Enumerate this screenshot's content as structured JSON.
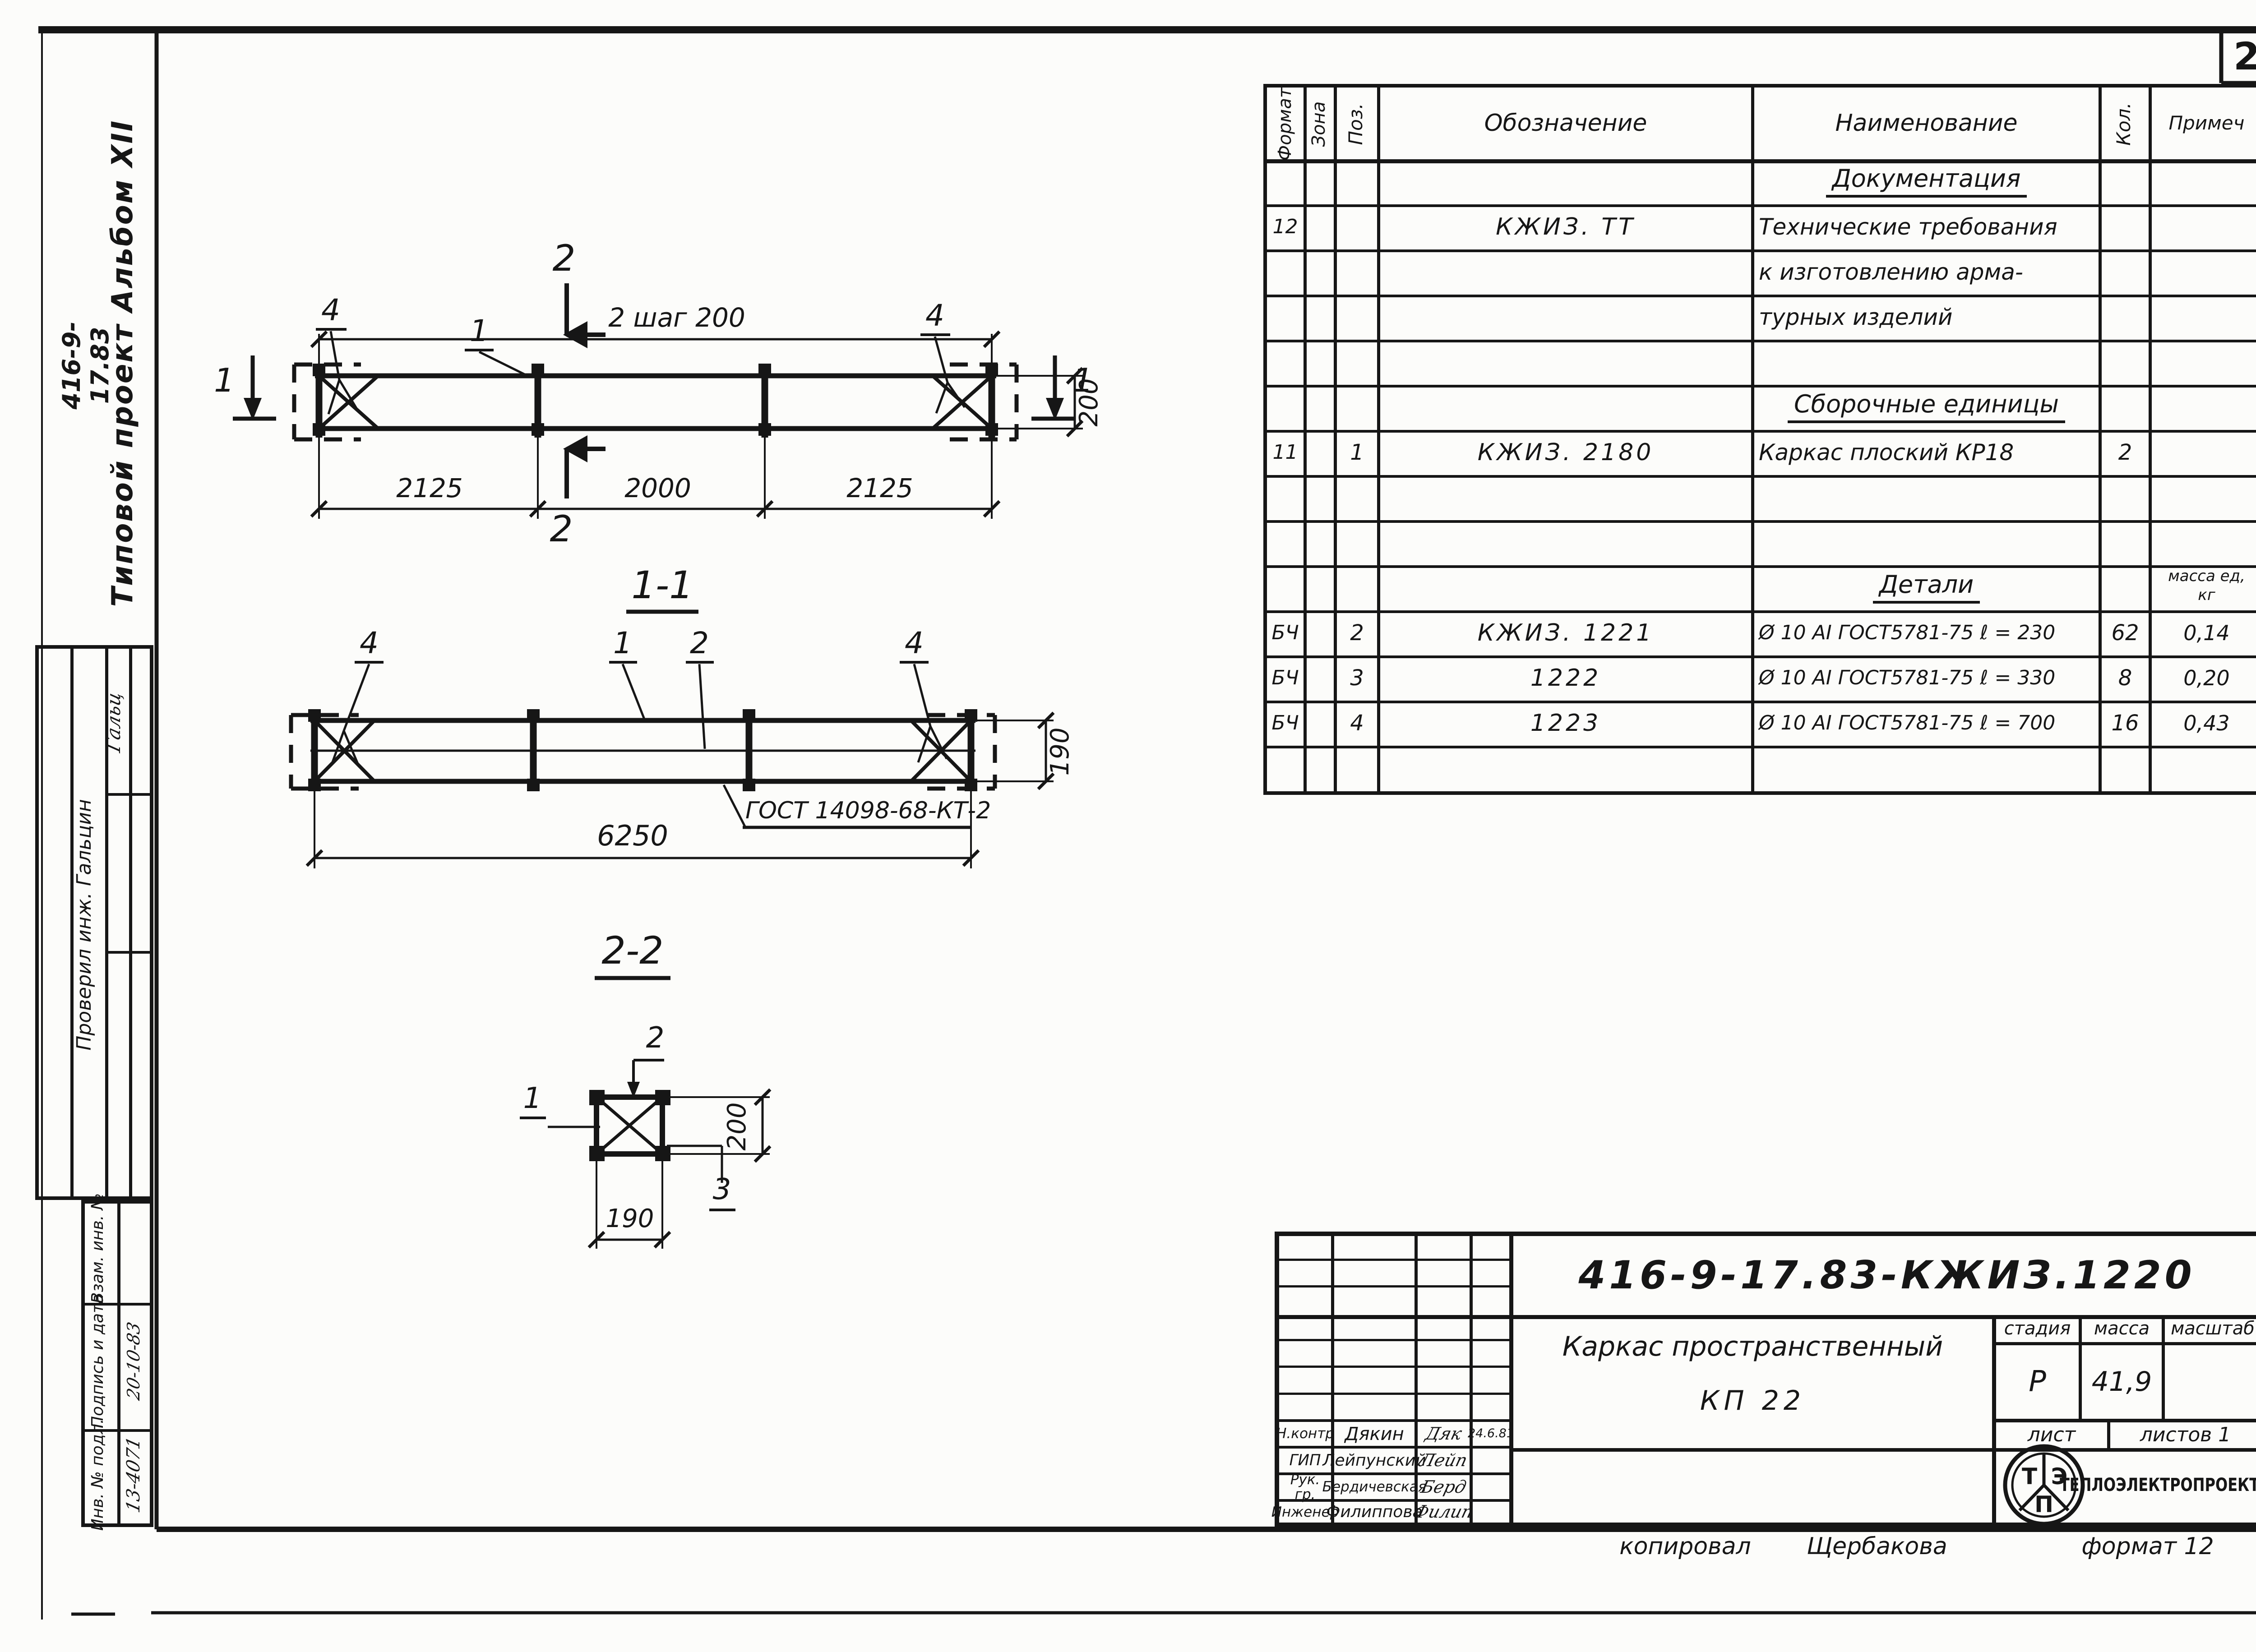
{
  "sheet": {
    "page_number": "25",
    "copied_label": "копировал",
    "copied_by": "Щербакова",
    "format_note": "формат 12"
  },
  "margin": {
    "doc_code": "416-9-17.83",
    "album": "Типовой проект   Альбом XII",
    "checked_by": "Проверил инж. Гальцин",
    "checked_sig": "Гальц",
    "stamp_labels": {
      "vzam": "Взам. инв. №",
      "podp": "Подпись и дата",
      "inv": "Инв. № подл."
    },
    "stamp_values": {
      "podp": "20-10-83",
      "inv": "13-4071"
    }
  },
  "spec": {
    "headers": {
      "format": "Формат",
      "zone": "Зона",
      "pos": "Поз.",
      "desig": "Обозначение",
      "name": "Наименование",
      "qty": "Кол.",
      "note": "Примеч"
    },
    "sections": {
      "documentation": "Документация",
      "assembly": "Сборочные единицы",
      "details": "Детали",
      "mass_unit_1": "масса ед,",
      "mass_unit_2": "кг"
    },
    "rows": [
      {
        "format": "12",
        "pos": "",
        "desig": "КЖИЗ. ТТ",
        "name": "Технические требования",
        "qty": "",
        "note": ""
      },
      {
        "format": "",
        "pos": "",
        "desig": "",
        "name": "к изготовлению арма-",
        "qty": "",
        "note": ""
      },
      {
        "format": "",
        "pos": "",
        "desig": "",
        "name": "турных изделий",
        "qty": "",
        "note": ""
      },
      {
        "format": "11",
        "pos": "1",
        "desig": "КЖИЗ. 2180",
        "name": "Каркас плоский КР18",
        "qty": "2",
        "note": ""
      },
      {
        "format": "БЧ",
        "pos": "2",
        "desig": "КЖИЗ. 1221",
        "name": "Ø 10 АI ГОСТ5781-75 ℓ = 230",
        "qty": "62",
        "note": "0,14"
      },
      {
        "format": "БЧ",
        "pos": "3",
        "desig": "1222",
        "name": "Ø 10 АI ГОСТ5781-75 ℓ = 330",
        "qty": "8",
        "note": "0,20"
      },
      {
        "format": "БЧ",
        "pos": "4",
        "desig": "1223",
        "name": "Ø 10 АI ГОСТ5781-75 ℓ = 700",
        "qty": "16",
        "note": "0,43"
      }
    ]
  },
  "drawings": {
    "plan": {
      "dim_top": "2   шаг 200",
      "dim_a": "2125",
      "dim_b": "2000",
      "dim_c": "2125",
      "dim_height": "200",
      "callout_left": "4",
      "callout_mid": "1",
      "callout_right": "4",
      "marker_top": "2",
      "marker_bottom": "2",
      "marker_left": "1",
      "marker_right": "1"
    },
    "s11": {
      "title": "1-1",
      "callout_left": "4",
      "callout_1": "1",
      "callout_2": "2",
      "callout_right": "4",
      "dim_height": "190",
      "dim_length": "6250",
      "weld_note": "ГОСТ 14098-68-КТ-2"
    },
    "s22": {
      "title": "2-2",
      "callout_1": "1",
      "callout_2": "2",
      "callout_3": "3",
      "dim_height": "200",
      "dim_width": "190"
    }
  },
  "title_block": {
    "doc_number": "416-9-17.83-КЖИЗ.1220",
    "title_line1": "Каркас пространственный",
    "title_line2": "КП 22",
    "labels": {
      "stage": "стадия",
      "mass": "масса",
      "scale": "масштаб",
      "sheet": "лист",
      "sheets": "листов 1"
    },
    "values": {
      "stage": "Р",
      "mass": "41,9",
      "scale": ""
    },
    "rows": [
      {
        "role": "Н.контр",
        "name": "Дякин",
        "sig": "Дяк",
        "date": "24.6.81"
      },
      {
        "role": "ГИП",
        "name": "Лейпунский",
        "sig": "Лейп",
        "date": ""
      },
      {
        "role": "Рук. гр.",
        "name": "Бердичевская",
        "sig": "Берд",
        "date": ""
      },
      {
        "role": "Инженер",
        "name": "Филиппова",
        "sig": "Филип",
        "date": ""
      }
    ],
    "logo": {
      "t": "Т",
      "e": "Э",
      "p": "П",
      "text": "ТЕПЛОЭЛЕКТРОПРОЕКТ"
    }
  }
}
